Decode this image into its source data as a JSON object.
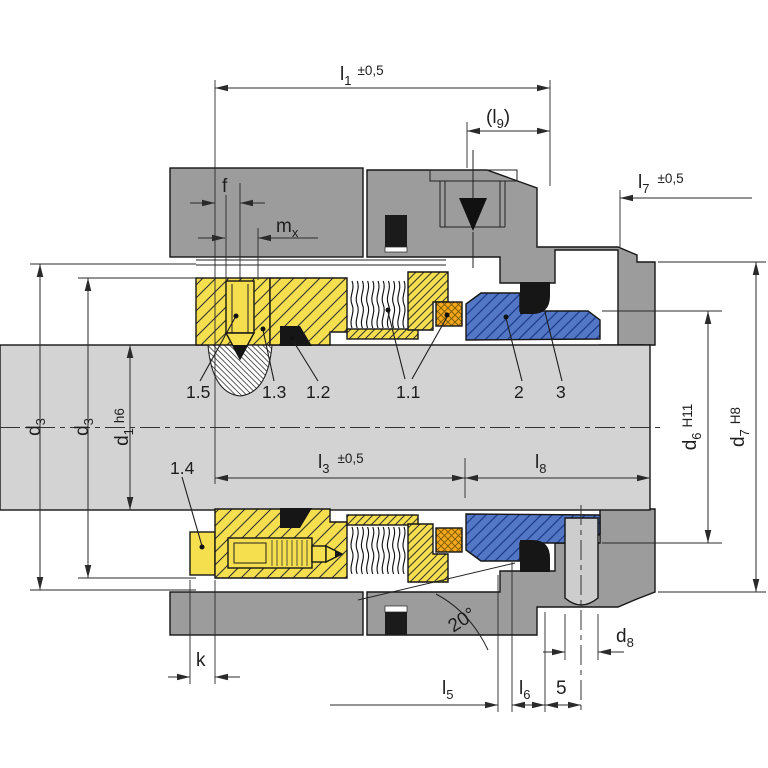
{
  "title": "Mechanical seal cross-section engineering drawing",
  "colors": {
    "housing": "#9c9c9c",
    "shaft": "#d3d3d3",
    "yellow": "#f6df4e",
    "orange": "#f2a71d",
    "blue": "#5377c4",
    "black_part": "#1b1b1b",
    "line": "#2a2a2a",
    "pin": "#cdcdcd"
  },
  "dimensions": {
    "l1": {
      "base": "l",
      "sub": "1",
      "tol": "±0,5"
    },
    "l9": {
      "open": "(",
      "base": "l",
      "sub": "9",
      "close": ")"
    },
    "l7": {
      "base": "l",
      "sub": "7",
      "tol": "±0,5"
    },
    "f": {
      "base": "f"
    },
    "mx": {
      "base": "m",
      "sub": "x"
    },
    "d3_outer": {
      "base": "d",
      "sub": "3"
    },
    "d3_inner": {
      "base": "d",
      "sub": "3"
    },
    "d1": {
      "base": "d",
      "sub": "1",
      "fit": "h6"
    },
    "l3": {
      "base": "l",
      "sub": "3",
      "tol": "±0,5"
    },
    "l8": {
      "base": "l",
      "sub": "8"
    },
    "d6": {
      "base": "d",
      "sub": "6",
      "fit": "H11"
    },
    "d7": {
      "base": "d",
      "sub": "7",
      "fit": "H8"
    },
    "d8": {
      "base": "d",
      "sub": "8"
    },
    "k": {
      "base": "k"
    },
    "l5": {
      "base": "l",
      "sub": "5"
    },
    "l6": {
      "base": "l",
      "sub": "6"
    },
    "dim5": {
      "base": "5"
    },
    "angle20": {
      "base": "20°"
    }
  },
  "part_labels": {
    "p1_5": "1.5",
    "p1_3": "1.3",
    "p1_2": "1.2",
    "p1_1": "1.1",
    "p2": "2",
    "p3": "3",
    "p1_4": "1.4"
  }
}
